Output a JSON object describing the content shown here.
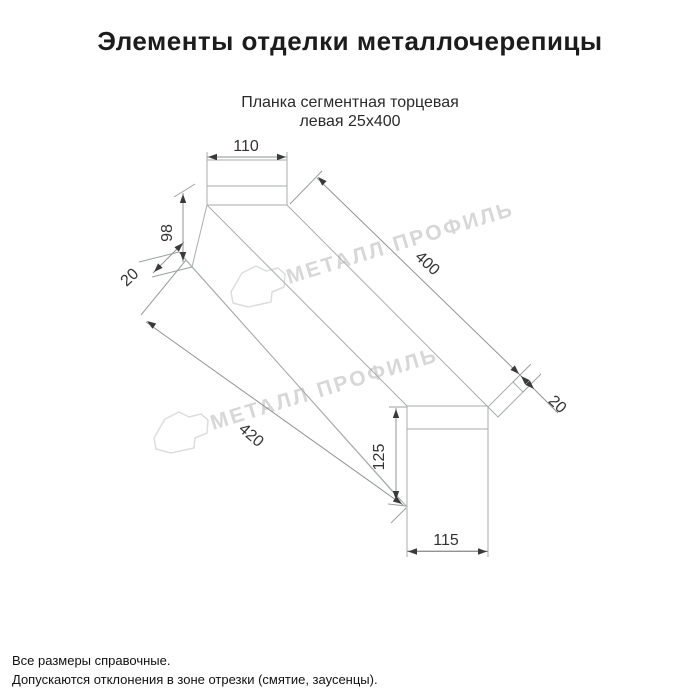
{
  "page": {
    "title": "Элементы отделки металлочерепицы"
  },
  "drawing": {
    "subtitle_line1": "Планка сегментная торцевая",
    "subtitle_line2": "левая 25х400"
  },
  "dimensions": {
    "top_flange_width": "110",
    "left_face_height": "98",
    "left_hem": "20",
    "top_edge_length": "400",
    "right_hem": "20",
    "bottom_edge_length": "420",
    "right_face_height": "125",
    "bottom_flange_width": "115"
  },
  "watermark": {
    "text": "МЕТАЛЛ ПРОФИЛЬ"
  },
  "footer": {
    "note1": "Все размеры справочные.",
    "note2": "Допускаются отклонения в зоне отрезки (смятие, заусенцы)."
  },
  "colors": {
    "background": "#ffffff",
    "part_line": "#a9aeae",
    "dimension_text": "#333333",
    "watermark": "#d7d7d7",
    "title_text": "#1c1c1c"
  }
}
